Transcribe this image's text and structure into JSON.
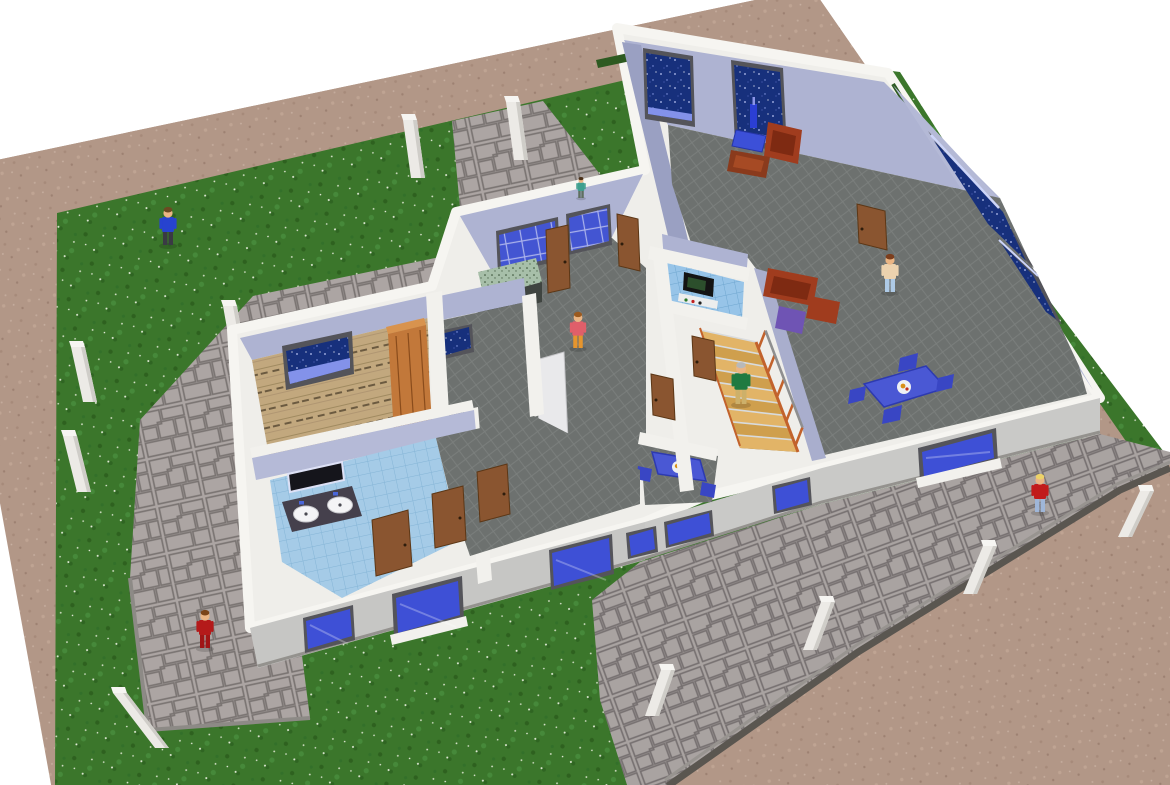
{
  "scene": {
    "label": "3D bird's-eye cut-away rendering of a single-storey house with garden, paved paths and people",
    "view": "perspective top-down cutaway",
    "background": "#ffffff"
  },
  "colors": {
    "dirt_border": "#b29787",
    "grass": "#3b762b",
    "grass_speckle": "#e4ecd9",
    "pavement": "#aca5a3",
    "pavement_joint": "#797371",
    "wall_top_white": "#f2f1ed",
    "wall_front_gray": "#c7c7c5",
    "interior_wall_lavender": "#aeb3d2",
    "interior_wall_shaded": "#9aa0c2",
    "carpet_gray": "#6d716f",
    "bathroom_tile": "#a5cbe7",
    "wc_tile": "#97c4e8",
    "bedroom_wood": "#c2a87e",
    "door_wood": "#8a5530",
    "wardrobe_wood": "#c2783a",
    "window_starry_glass": "#17307c",
    "window_frame": "#54545a",
    "front_window_glass": "#3e50d6",
    "kitchen_window": "#4355d2",
    "stair_wood": "#e2b467",
    "stair_rail_orange": "#c2622c",
    "counter_dark": "#3f4440",
    "counter_granite": "#a7bfa9",
    "sofa_red": "#a03c1e",
    "chair_purple": "#6f54b4",
    "table_blue": "#4a58d4",
    "low_wall": "#5a5650",
    "fence_post": "#eceae6"
  },
  "ground": {
    "areas": [
      {
        "name": "dirt-border",
        "material": "sandy earth strip framing the lot"
      },
      {
        "name": "lawn",
        "material": "green grass with white flower speckles"
      },
      {
        "name": "north-path",
        "material": "gray block paving"
      },
      {
        "name": "west-patio",
        "material": "gray block paving"
      },
      {
        "name": "front-terrace",
        "material": "gray block paving with low retaining wall"
      },
      {
        "name": "rear-dirt-yard",
        "material": "sandy earth"
      }
    ]
  },
  "house": {
    "style": "cut-away walls, white wall tops, lavender interior faces, gray exterior front",
    "rooms": [
      {
        "name": "living-room",
        "floor": "dark gray carpet",
        "furniture": [
          "red armchair",
          "red armchair",
          "red sofa",
          "purple armchair",
          "blue coffee table with blue bottle",
          "brown side table",
          "blue dining table with plate of food",
          "blue dining chairs"
        ],
        "windows": "starry dark-blue glass, two on north wall, two on east wall"
      },
      {
        "name": "kitchen",
        "floor": "gray carpet",
        "furniture": [
          "dark counter with granite top",
          "white appliance",
          "red bottles"
        ],
        "windows": "blue gridded band windows"
      },
      {
        "name": "wc-blue",
        "floor": "blue tile",
        "furniture": [
          "black stove",
          "shelf with bottles"
        ]
      },
      {
        "name": "stair-hall",
        "floor": "gray carpet",
        "furniture": [
          "blue breakfast table with plate",
          "blue chairs"
        ]
      },
      {
        "name": "bedroom",
        "floor": "rustic wood planks",
        "furniture": [
          "tall wooden wardrobe"
        ],
        "windows": "starry dark-blue window"
      },
      {
        "name": "small-room",
        "floor": "gray carpet",
        "windows": "small starry window"
      },
      {
        "name": "bathroom",
        "floor": "light blue tile",
        "furniture": [
          "dark vanity with two white sinks",
          "wall mirror"
        ]
      },
      {
        "name": "corridor",
        "floor": "gray carpet",
        "furniture": [
          "wooden doors"
        ]
      }
    ],
    "staircase": {
      "visible_steps": 9,
      "material": "light wood treads, orange balusters, gray handrail"
    },
    "doors_count": 9
  },
  "people": [
    {
      "id": "man-lawn",
      "role": "man in blue shirt walking on the lawn",
      "x": 168,
      "y": 245,
      "s": 1,
      "shirt": "#2743cf",
      "pants": "#3a3a44",
      "hair": "#6b4a22",
      "skin": "#eab584"
    },
    {
      "id": "woman-red-patio",
      "role": "woman in red on the west patio",
      "x": 205,
      "y": 648,
      "s": 1,
      "shirt": "#b41a1a",
      "pants": "#a01616",
      "hair": "#7a4418",
      "skin": "#eab584"
    },
    {
      "id": "man-red-path",
      "role": "blond person in red sweater on the side path",
      "x": 1040,
      "y": 512,
      "s": 1,
      "shirt": "#c11b1b",
      "pants": "#9fb6d8",
      "hair": "#ecd268",
      "skin": "#eab584"
    },
    {
      "id": "woman-kitchen",
      "role": "woman standing in the kitchen hall",
      "x": 578,
      "y": 348,
      "s": 0.95,
      "shirt": "#e05f6a",
      "pants": "#e6952d",
      "hair": "#9a5a20",
      "skin": "#eab584"
    },
    {
      "id": "man-stairs",
      "role": "gray-haired man in green sweater on stairs",
      "x": 741,
      "y": 404,
      "s": 1.1,
      "shirt": "#1f7a41",
      "pants": "#cdb06a",
      "hair": "#b9b9b9",
      "skin": "#eab584"
    },
    {
      "id": "person-window",
      "role": "person in beige by the living room windows",
      "x": 890,
      "y": 292,
      "s": 1,
      "shirt": "#ecd2ae",
      "pants": "#aecae6",
      "hair": "#7c3e1d",
      "skin": "#eab584"
    },
    {
      "id": "person-entrance",
      "role": "small figure at the north entrance",
      "x": 581,
      "y": 198,
      "s": 0.55,
      "shirt": "#3f9f8f",
      "pants": "#5f6f60",
      "hair": "#4a3018",
      "skin": "#eab584"
    }
  ],
  "fence_posts": [
    {
      "x": 418,
      "y": 178,
      "h": 58,
      "dx": -8
    },
    {
      "x": 521,
      "y": 160,
      "h": 58,
      "dx": -8
    },
    {
      "x": 240,
      "y": 362,
      "h": 56,
      "dx": -10
    },
    {
      "x": 90,
      "y": 402,
      "h": 55,
      "dx": -12
    },
    {
      "x": 84,
      "y": 492,
      "h": 56,
      "dx": -14
    },
    {
      "x": 162,
      "y": 748,
      "h": 55,
      "dx": -42
    },
    {
      "x": 652,
      "y": 716,
      "h": 46,
      "dx": 16
    },
    {
      "x": 810,
      "y": 650,
      "h": 48,
      "dx": 18
    },
    {
      "x": 970,
      "y": 594,
      "h": 48,
      "dx": 20
    },
    {
      "x": 1125,
      "y": 537,
      "h": 46,
      "dx": 22
    }
  ]
}
